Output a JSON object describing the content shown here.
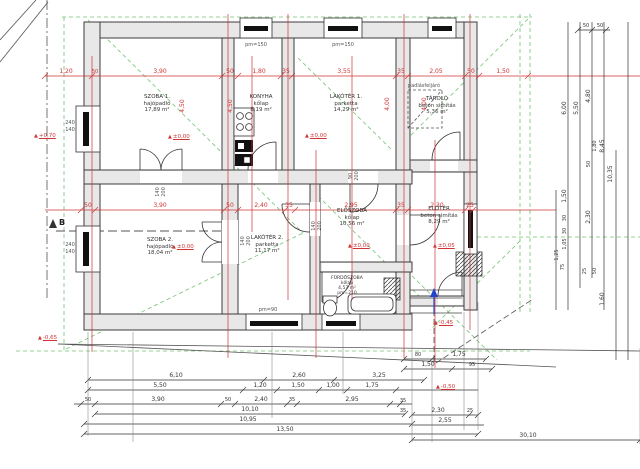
{
  "rooms": [
    {
      "name": "SZOBA 1.",
      "finish": "hajópadló",
      "area": "17,89 m²"
    },
    {
      "name": "KONYHA",
      "finish": "kőlap",
      "area": "8,19 m²"
    },
    {
      "name": "LAKÓTÉR 1.",
      "finish": "parketta",
      "area": "14,29 m²"
    },
    {
      "name": "TÁROLÓ",
      "finish": "beton simítás",
      "area": "5,36 m²"
    },
    {
      "name": "SZOBA 2.",
      "finish": "hajópadló",
      "area": "18,04 m²"
    },
    {
      "name": "LAKÓTÉR 2.",
      "finish": "parketta",
      "area": "11,17 m²"
    },
    {
      "name": "ELŐSZOBA",
      "finish": "kőlap",
      "area": "10,56 m²"
    },
    {
      "name": "FÜRDŐSZOBA",
      "finish": "kőlap",
      "area": "4,57 m²",
      "pm": "pm=210"
    },
    {
      "name": "ELŐTÉR",
      "finish": "beton simítás",
      "area": "8,29 m²"
    }
  ],
  "levels": [
    "+0,70",
    "±0,00",
    "±0,00",
    "±0,00",
    "±0,00",
    "±0,05",
    "-0,45",
    "-0,50",
    "-0,65"
  ],
  "annotations": {
    "attic": "padlásfeljáró",
    "section_mark": "B",
    "pm150": "pm=150",
    "pm90": "pm=90"
  },
  "openings": {
    "window_240_140": [
      "240",
      "140"
    ],
    "door_140_200": [
      "140",
      "200"
    ],
    "door_90_200": [
      "90",
      "200"
    ]
  },
  "dims": {
    "top": [
      "1,20",
      "50",
      "3,90",
      "50",
      "1,80",
      "35",
      "3,55",
      "35",
      "2,05",
      "50",
      "1,50"
    ],
    "middle": [
      "50",
      "3,90",
      "50",
      "2,40",
      "35",
      "2,95",
      "35",
      "2,30",
      "25"
    ],
    "plan_vertical": [
      "4,50",
      "4,50",
      "4,00",
      "4,00"
    ],
    "b1": [
      "6,10",
      "2,60",
      "3,25"
    ],
    "b1r": [
      "80",
      "1,75"
    ],
    "b2": [
      "5,50",
      "1,20",
      "1,50",
      "1,00",
      "1,75"
    ],
    "b2r": [
      "1,50",
      "95"
    ],
    "b3": [
      "50",
      "3,90",
      "50",
      "2,40",
      "35",
      "2,95"
    ],
    "b3r": [
      "35",
      "35"
    ],
    "b4": [
      "10,10"
    ],
    "b4r": [
      "2,30",
      "25"
    ],
    "b5": [
      "10,95"
    ],
    "b5r": [
      "2,55"
    ],
    "b6": [
      "13,50"
    ],
    "b7": [
      "30,10"
    ],
    "right": [
      "50",
      "50",
      "6,00",
      "5,50",
      "4,80",
      "1,80",
      "8,45",
      "50",
      "10,35",
      "1,50",
      "30",
      "2,30",
      "30",
      "1,05",
      "1,25",
      "75",
      "25",
      "50",
      "1,60"
    ]
  },
  "colors": {
    "dim_red": "#cf3333",
    "roof_green": "#5cb85c",
    "wall_fill": "#e8e8e8",
    "line": "#3c3c3c",
    "entry_blue": "#2443cc"
  }
}
